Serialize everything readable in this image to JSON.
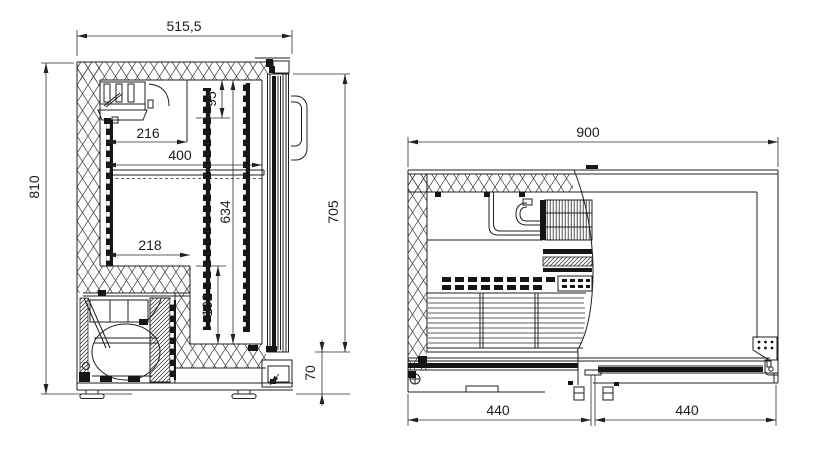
{
  "drawing": {
    "side_view": {
      "overall_depth": "515,5",
      "overall_height": "810",
      "evap_zone_height": "95",
      "evap_depth": "216",
      "shelf_depth": "400",
      "interior_height": "634",
      "step_depth": "218",
      "step_height": "192",
      "door_height": "705",
      "base_height": "70"
    },
    "top_view": {
      "overall_width": "900",
      "left_section_width": "440",
      "right_section_width": "440"
    },
    "colors": {
      "line": "#1f1f1f",
      "background": "#ffffff"
    }
  }
}
